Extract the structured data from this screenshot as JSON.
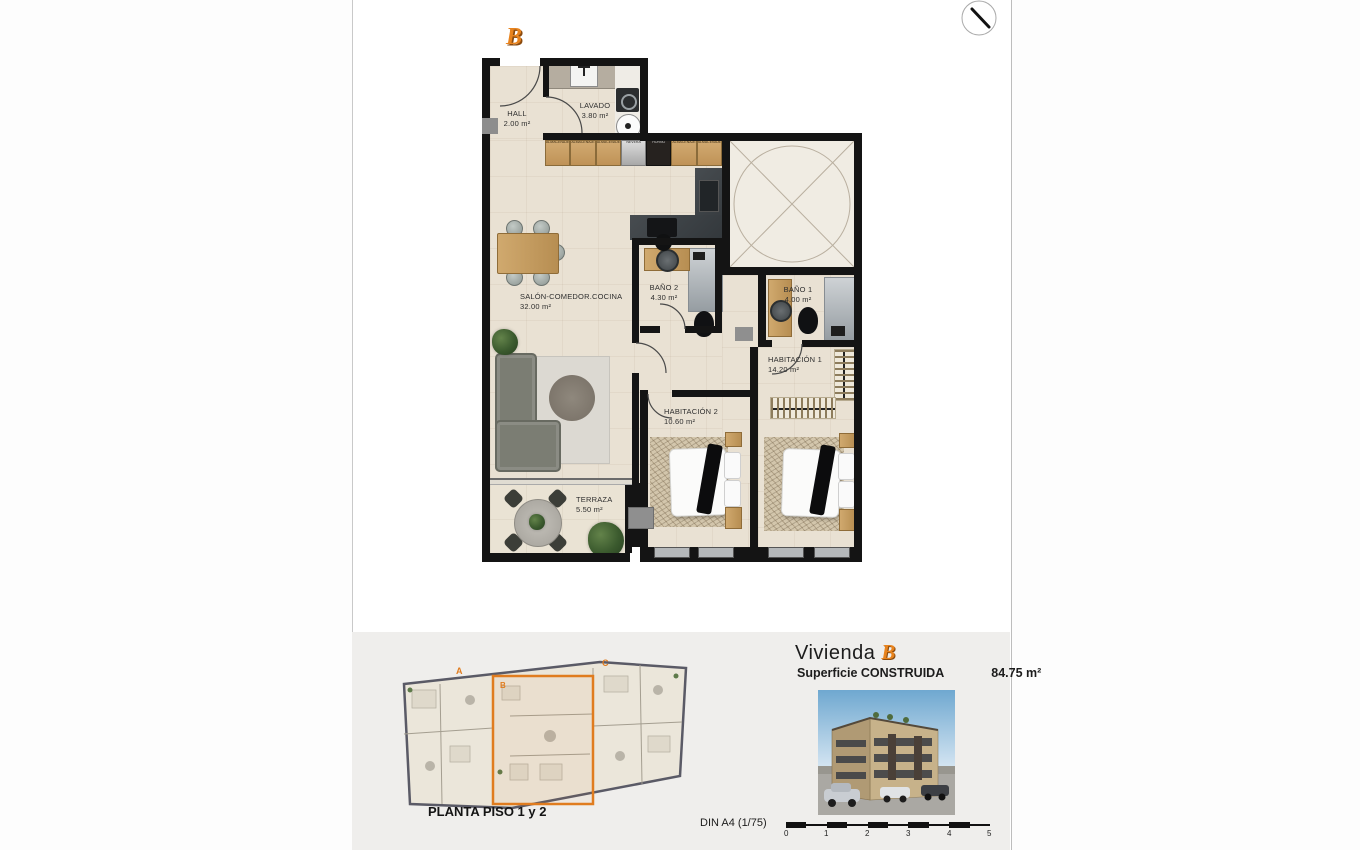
{
  "accent": "#e8831d",
  "plan": {
    "unit_badge": "B",
    "rooms": {
      "hall": {
        "name": "HALL",
        "area": "2.00 m²"
      },
      "lavado": {
        "name": "LAVADO",
        "area": "3.80 m²"
      },
      "salon": {
        "name": "SALÓN-COMEDOR.COCINA",
        "area": "32.00 m²"
      },
      "bano2": {
        "name": "BAÑO 2",
        "area": "4.30 m²"
      },
      "bano1": {
        "name": "BAÑO 1",
        "area": "4.00 m²"
      },
      "hab1": {
        "name": "HABITACIÓN 1",
        "area": "14.20 m²"
      },
      "hab2": {
        "name": "HABITACIÓN 2",
        "area": "10.60 m²"
      },
      "terraza": {
        "name": "TERRAZA",
        "area": "5.50 m²"
      }
    },
    "kitchen_cabinets": [
      "ALMACENAJE",
      "ALMACENAJE",
      "ALMACENAJE",
      "NEVERA",
      "HORNO",
      "ALMACENAJE",
      "ALMACENAJE"
    ]
  },
  "footer": {
    "site_plan_caption": "PLANTA PISO 1 y 2",
    "unit_marks": {
      "a": "A",
      "b": "B",
      "c": "C"
    },
    "title": "Vivienda",
    "title_unit": "B",
    "surface_label": "Superficie CONSTRUIDA",
    "surface_value": "84.75 m²",
    "scale_label": "DIN A4 (1/75)",
    "scale_ticks": [
      "0",
      "1",
      "2",
      "3",
      "4",
      "5"
    ]
  }
}
